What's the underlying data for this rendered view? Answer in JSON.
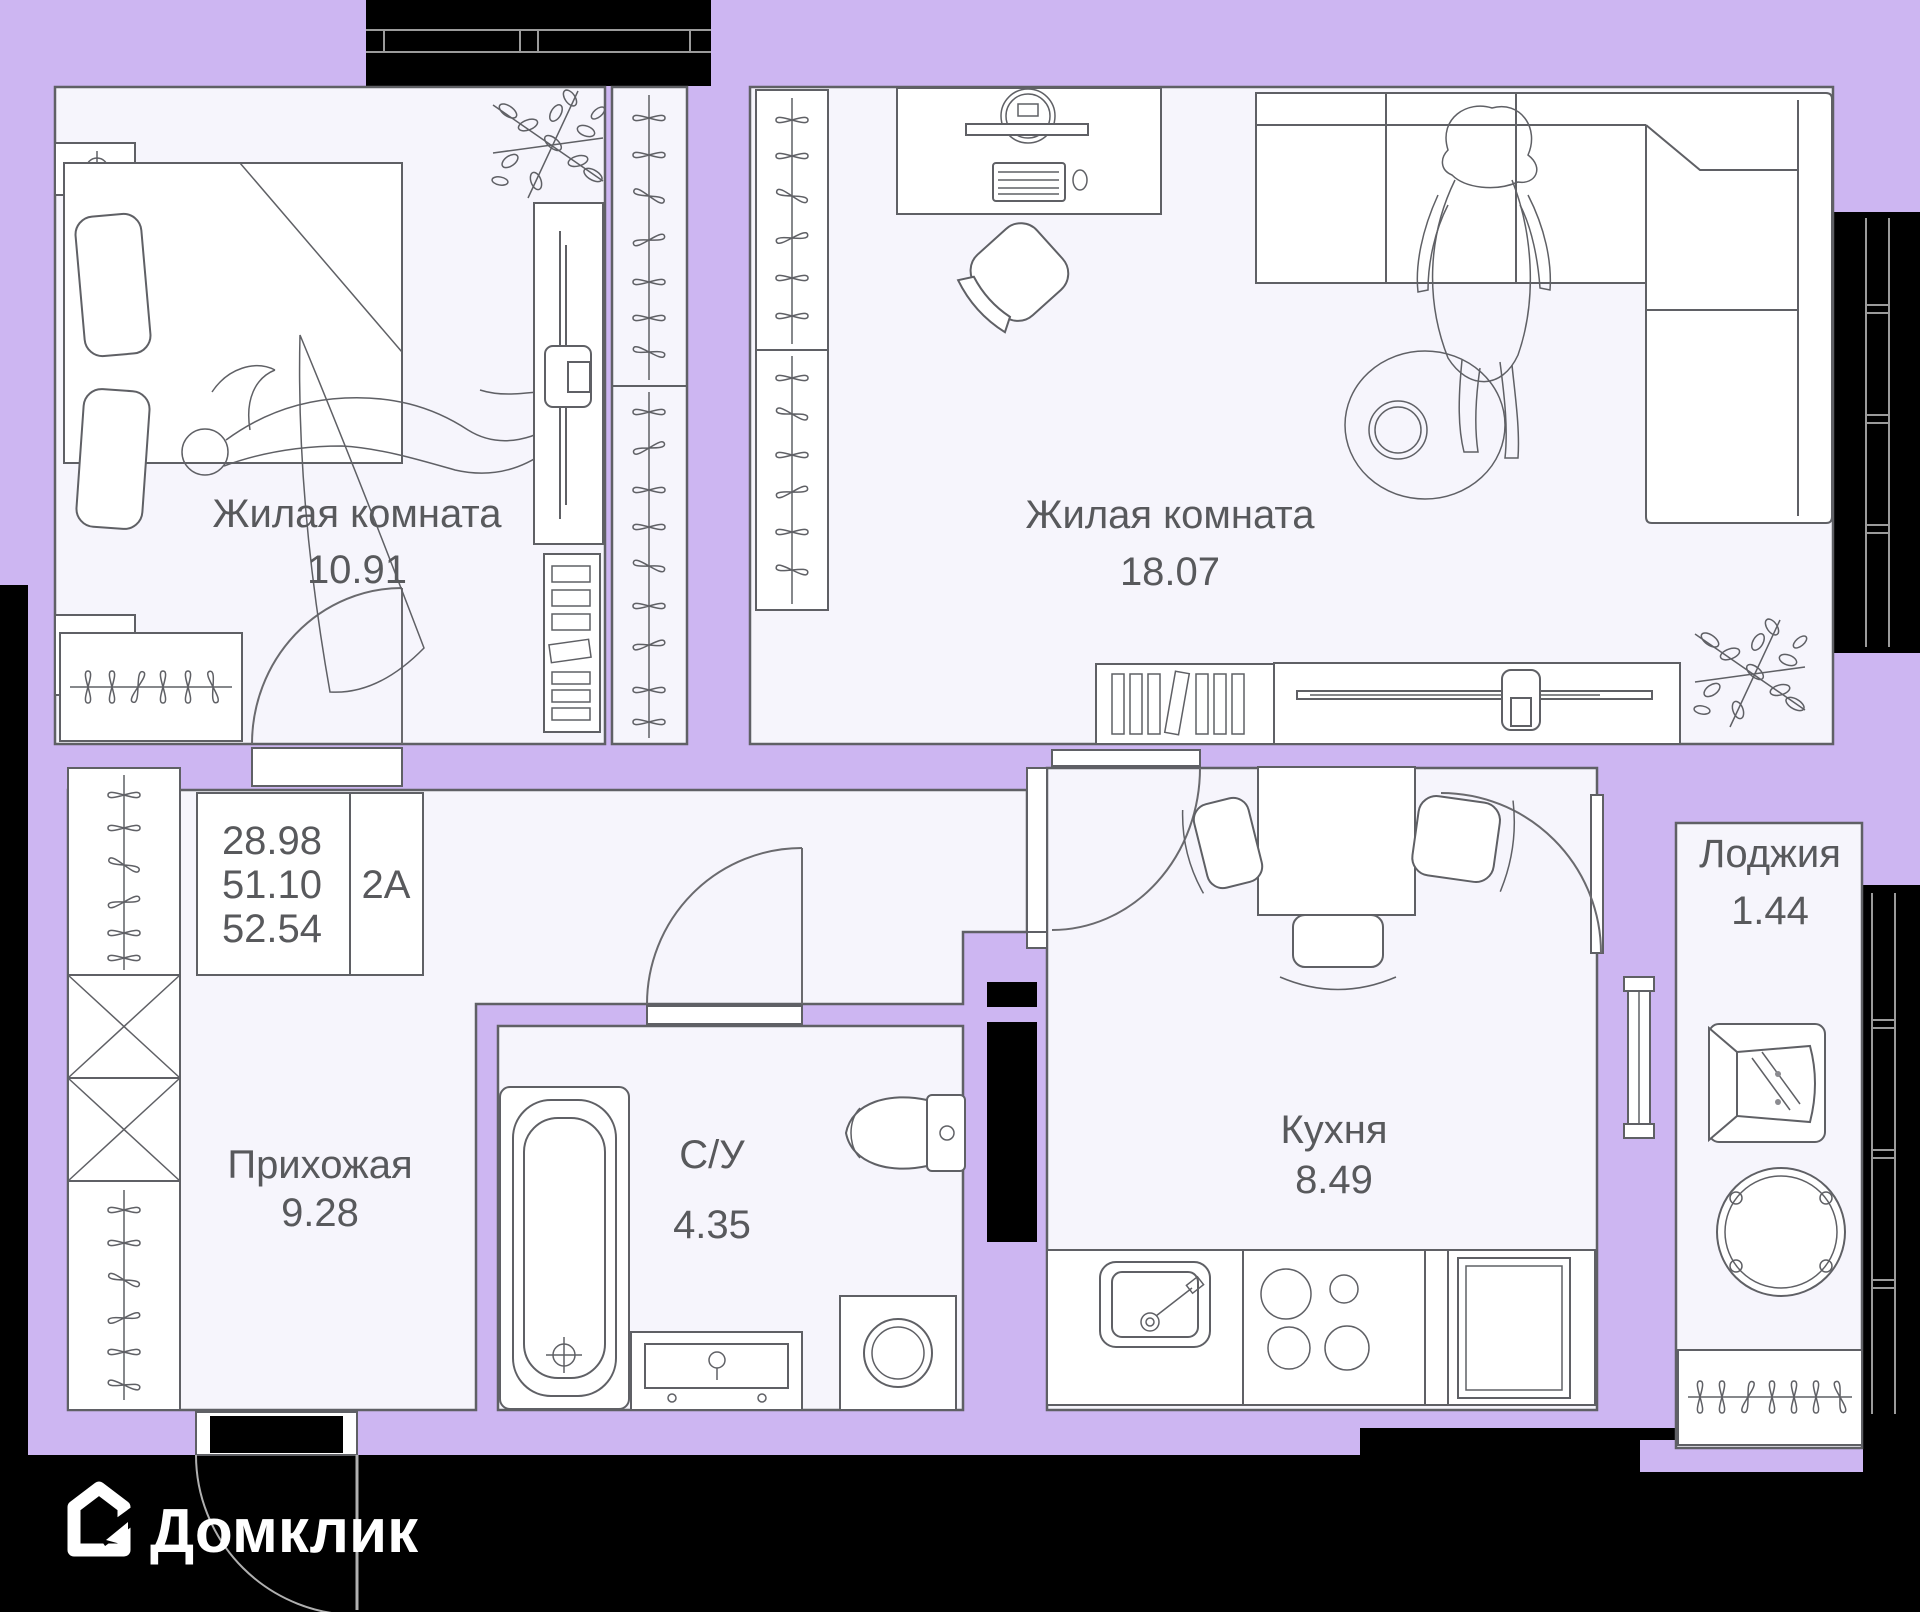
{
  "brand": {
    "logo_text": "Домклик"
  },
  "info_box": {
    "areas": [
      "28.98",
      "51.10",
      "52.54"
    ],
    "unit": "2А"
  },
  "rooms": [
    {
      "id": "living-1",
      "name": "Жилая комната",
      "area": "10.91"
    },
    {
      "id": "living-2",
      "name": "Жилая комната",
      "area": "18.07"
    },
    {
      "id": "hallway",
      "name": "Прихожая",
      "area": "9.28"
    },
    {
      "id": "bathroom",
      "name": "С/У",
      "area": "4.35"
    },
    {
      "id": "kitchen",
      "name": "Кухня",
      "area": "8.49"
    },
    {
      "id": "loggia",
      "name": "Лоджия",
      "area": "1.44"
    }
  ],
  "colors": {
    "wall": "#cdb6f2",
    "floor": "#f6f5fc",
    "outline": "#5f6065",
    "exterior": "#000000",
    "label": "#58595c",
    "logo": "#ffffff"
  }
}
